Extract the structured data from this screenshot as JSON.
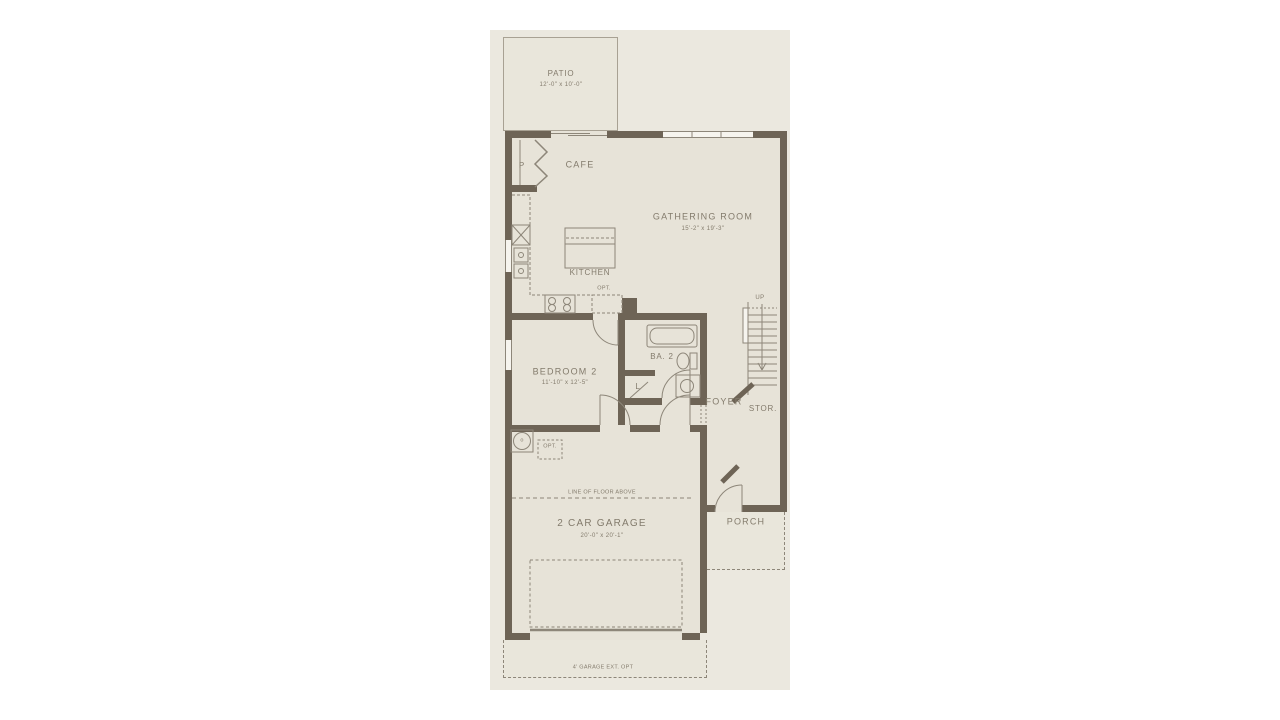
{
  "plan": {
    "colors": {
      "page": "#ffffff",
      "sheet": "#ebe8df",
      "room": "#e7e3d8",
      "patio": "#e9e6db",
      "wall": "#6e6456",
      "line": "#8d8679",
      "text": "#837b6c"
    },
    "rooms": {
      "patio": {
        "name": "PATIO",
        "dims": "12'-0\" x 10'-0\""
      },
      "cafe": {
        "name": "CAFE"
      },
      "pantry": {
        "name": "P"
      },
      "kitchen": {
        "name": "KITCHEN"
      },
      "gathering": {
        "name": "GATHERING ROOM",
        "dims": "15'-2\" x 19'-3\""
      },
      "bedroom2": {
        "name": "BEDROOM 2",
        "dims": "11'-10\" x 12'-5\""
      },
      "bath2": {
        "name": "BA. 2"
      },
      "linen": {
        "name": "L"
      },
      "foyer": {
        "name": "FOYER"
      },
      "storage": {
        "name": "STOR."
      },
      "garage": {
        "name": "2 CAR GARAGE",
        "dims": "20'-0\" x 20'-1\""
      },
      "porch": {
        "name": "PORCH"
      }
    },
    "annotations": {
      "up": "UP",
      "opt_kitchen": "OPT.",
      "opt_garage": "OPT.",
      "line_of_floor_above": "LINE OF FLOOR ABOVE",
      "garage_ext": "4' GARAGE EXT. OPT",
      "water_heater": "o"
    }
  }
}
